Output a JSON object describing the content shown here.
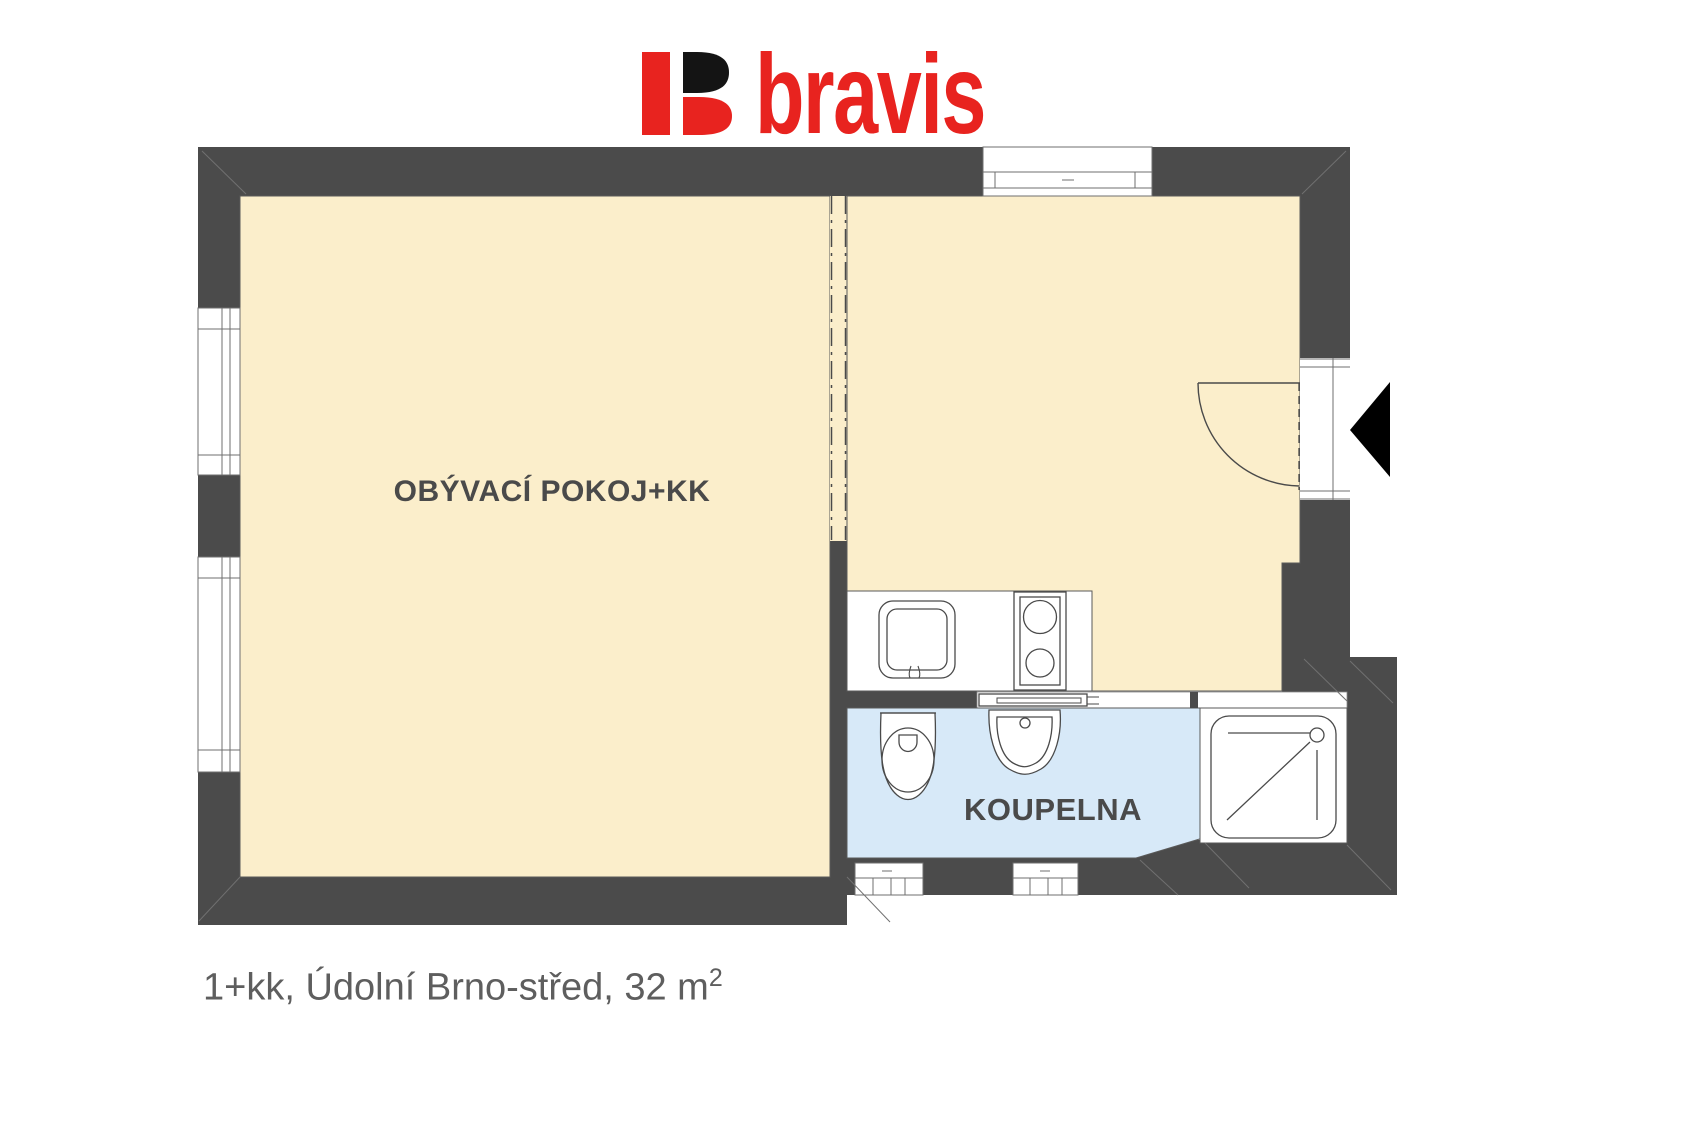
{
  "logo": {
    "text": "bravis",
    "colors": {
      "red": "#E8231F",
      "black": "#141414"
    }
  },
  "floor_plan": {
    "wall_color": "#4B4B4B",
    "outline_color": "#5a5a5a",
    "rooms": [
      {
        "id": "living-room-kitchenette",
        "label": "OBÝVACÍ POKOJ+KK",
        "fill": "#FBEECB"
      },
      {
        "id": "bathroom",
        "label": "KOUPELNA",
        "fill": "#D7E9F8"
      }
    ],
    "fixtures": [
      "kitchen-sink",
      "stove",
      "sliding-door",
      "toilet",
      "washbasin",
      "shower",
      "entrance-door",
      "entrance-arrow",
      "window-left-upper",
      "window-left-lower",
      "window-top",
      "vent-left",
      "vent-right"
    ]
  },
  "caption": {
    "text": "1+kk, Údolní Brno-střed, 32 m",
    "superscript": "2"
  }
}
